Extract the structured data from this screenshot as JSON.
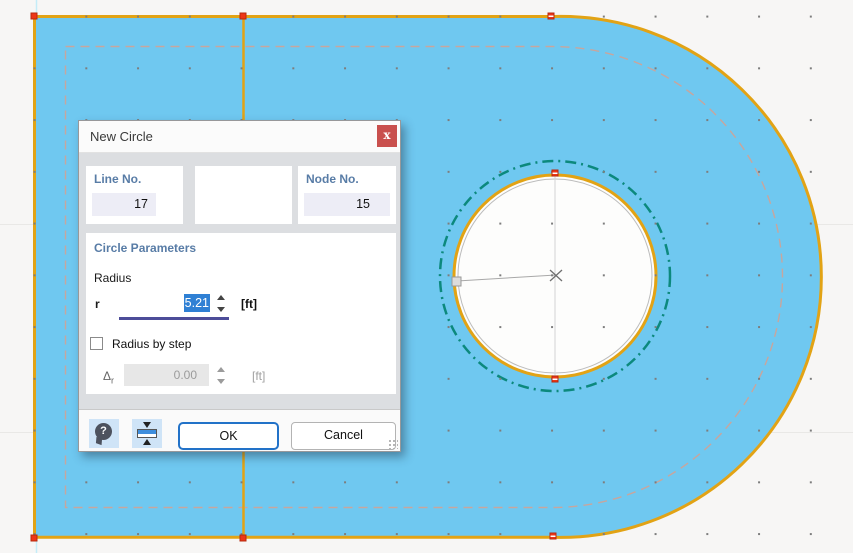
{
  "dialog": {
    "title": "New Circle",
    "close_glyph": "x",
    "line_no": {
      "label": "Line No.",
      "value": "17"
    },
    "node_no": {
      "label": "Node No.",
      "value": "15"
    },
    "circle_params": {
      "section_title": "Circle Parameters",
      "radius_heading": "Radius",
      "r_label": "r",
      "r_value": "5.21",
      "r_unit": "[ft]",
      "radius_by_step_label": "Radius by step",
      "delta_symbol": "Δ",
      "delta_sub": "r",
      "delta_value": "0.00",
      "delta_unit": "[ft]"
    },
    "help_glyph": "?",
    "buttons": {
      "ok": "OK",
      "cancel": "Cancel"
    }
  },
  "canvas": {
    "colors": {
      "background": "#f7f6f5",
      "surface_fill": "#6fc8f0",
      "surface_outline": "#e2a315",
      "new_circle_teal": "#0c897d",
      "offset_dash": "#c7a69e",
      "node_red": "#ee3517",
      "selection_blue": "#2f80d4",
      "label_blue": "#587ca6",
      "close_red": "#c9504e",
      "ok_border_blue": "#2272c8"
    }
  }
}
